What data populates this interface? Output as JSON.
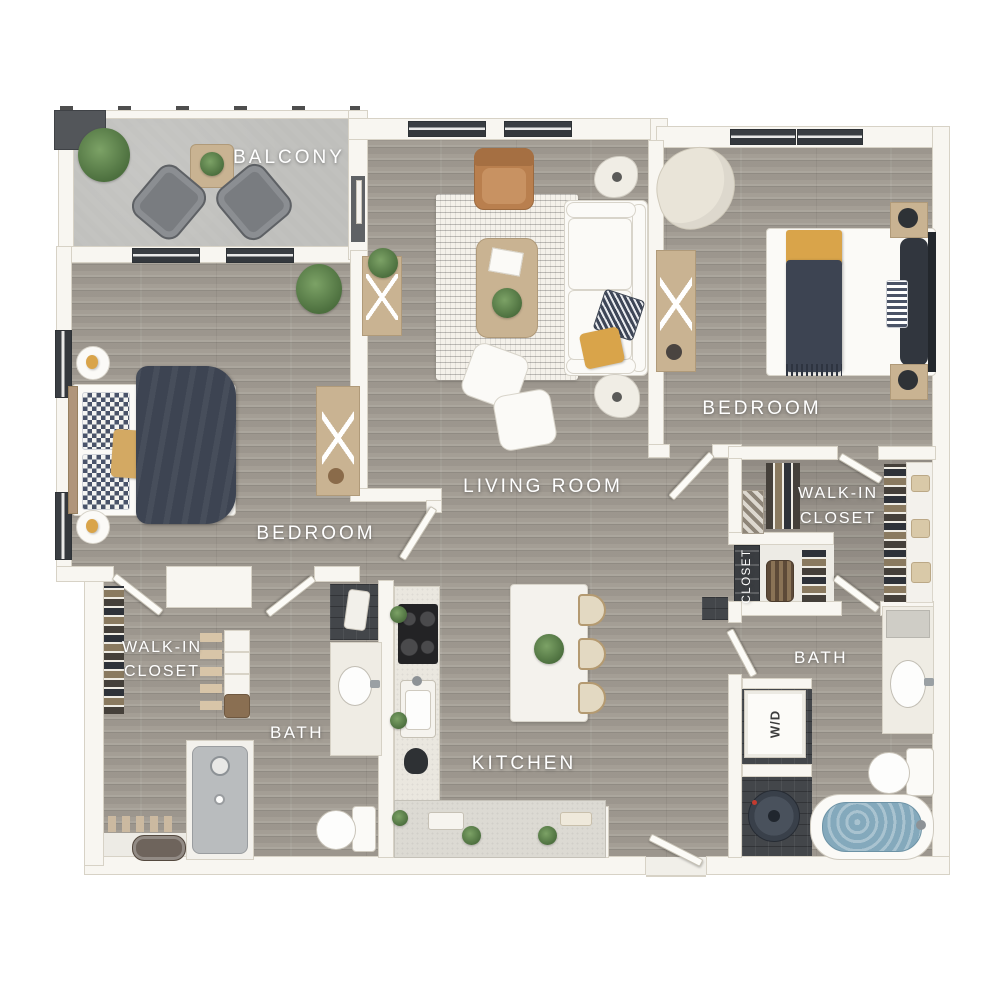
{
  "rooms": {
    "balcony": {
      "label": "BALCONY"
    },
    "living_room": {
      "label": "LIVING ROOM"
    },
    "bedroom_right": {
      "label": "BEDROOM"
    },
    "bedroom_left": {
      "label": "BEDROOM"
    },
    "walk_in_closet_right": {
      "line1": "WALK-IN",
      "line2": "CLOSET"
    },
    "walk_in_closet_left": {
      "line1": "WALK-IN",
      "line2": "CLOSET"
    },
    "closet": {
      "label": "CLOSET"
    },
    "bath_right": {
      "label": "BATH"
    },
    "bath_left": {
      "label": "BATH"
    },
    "kitchen": {
      "label": "KITCHEN"
    },
    "laundry": {
      "label": "W/D"
    }
  },
  "palette": {
    "background": "#ffffff",
    "wall": "#f8f6f1",
    "wall_edge": "#d7d2c6",
    "wood_floor": "#a49e95",
    "balcony_concrete": "#bfbfbc",
    "slate_floor": "#43464a",
    "label_text": "#ffffff",
    "accent_navy": "#3d4452",
    "accent_mustard": "#d9a44a",
    "leather_tan": "#b97f4e",
    "wood_furniture": "#c9b392",
    "plant_green": "#5d7f4e",
    "tub_water": "#84a9bc"
  }
}
